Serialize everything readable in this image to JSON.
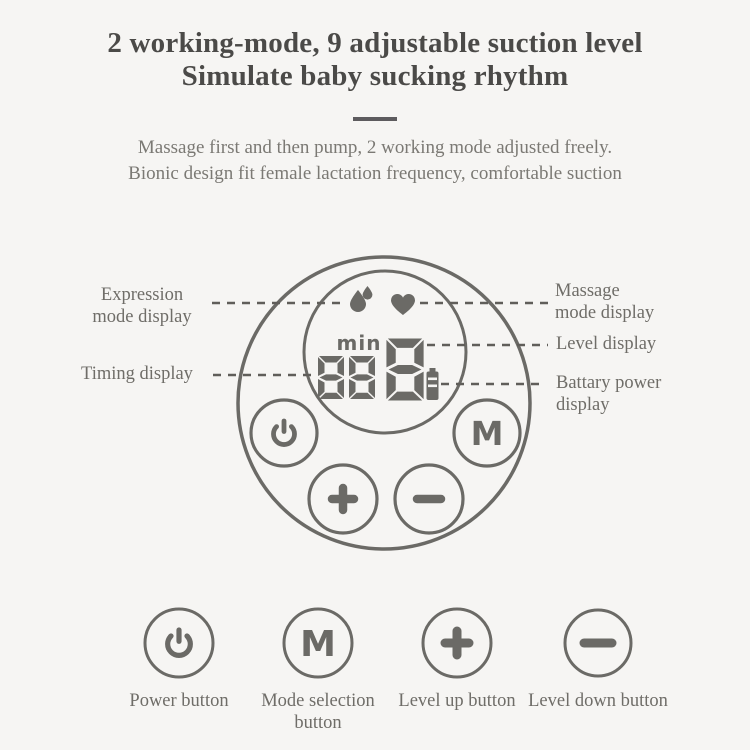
{
  "header": {
    "title_line1": "2 working-mode, 9 adjustable suction level",
    "title_line2": "Simulate baby sucking rhythm",
    "subtitle_line1": "Massage first and then pump, 2 working mode adjusted freely.",
    "subtitle_line2": "Bionic design fit female lactation frequency, comfortable suction"
  },
  "diagram": {
    "callouts": {
      "expression": {
        "line1": "Expression",
        "line2": "mode display"
      },
      "massage": {
        "line1": "Massage",
        "line2": "mode display"
      },
      "level": {
        "label": "Level display"
      },
      "timing": {
        "label": "Timing display"
      },
      "battery": {
        "line1": "Battary power",
        "line2": "display"
      }
    },
    "display": {
      "min_label": "min",
      "timing_value": "88",
      "level_value": "8",
      "icons": [
        "water-drops-icon",
        "heart-icon",
        "battery-icon"
      ]
    },
    "buttons": {
      "power_glyph": "power",
      "mode_glyph": "M",
      "level_up_glyph": "plus",
      "level_down_glyph": "minus"
    }
  },
  "legend": {
    "buttons": [
      {
        "glyph": "power",
        "label": "Power button"
      },
      {
        "glyph": "M",
        "label_line1": "Mode selection",
        "label_line2": "button"
      },
      {
        "glyph": "plus",
        "label": "Level up button"
      },
      {
        "glyph": "minus",
        "label": "Level down button"
      }
    ]
  },
  "colors": {
    "background": "#f6f5f3",
    "title_text": "#4b4a48",
    "muted_text": "#7b7974",
    "label_text": "#6f6d68",
    "line_gray": "#6b6a66",
    "dash_gray": "#605e5a"
  }
}
